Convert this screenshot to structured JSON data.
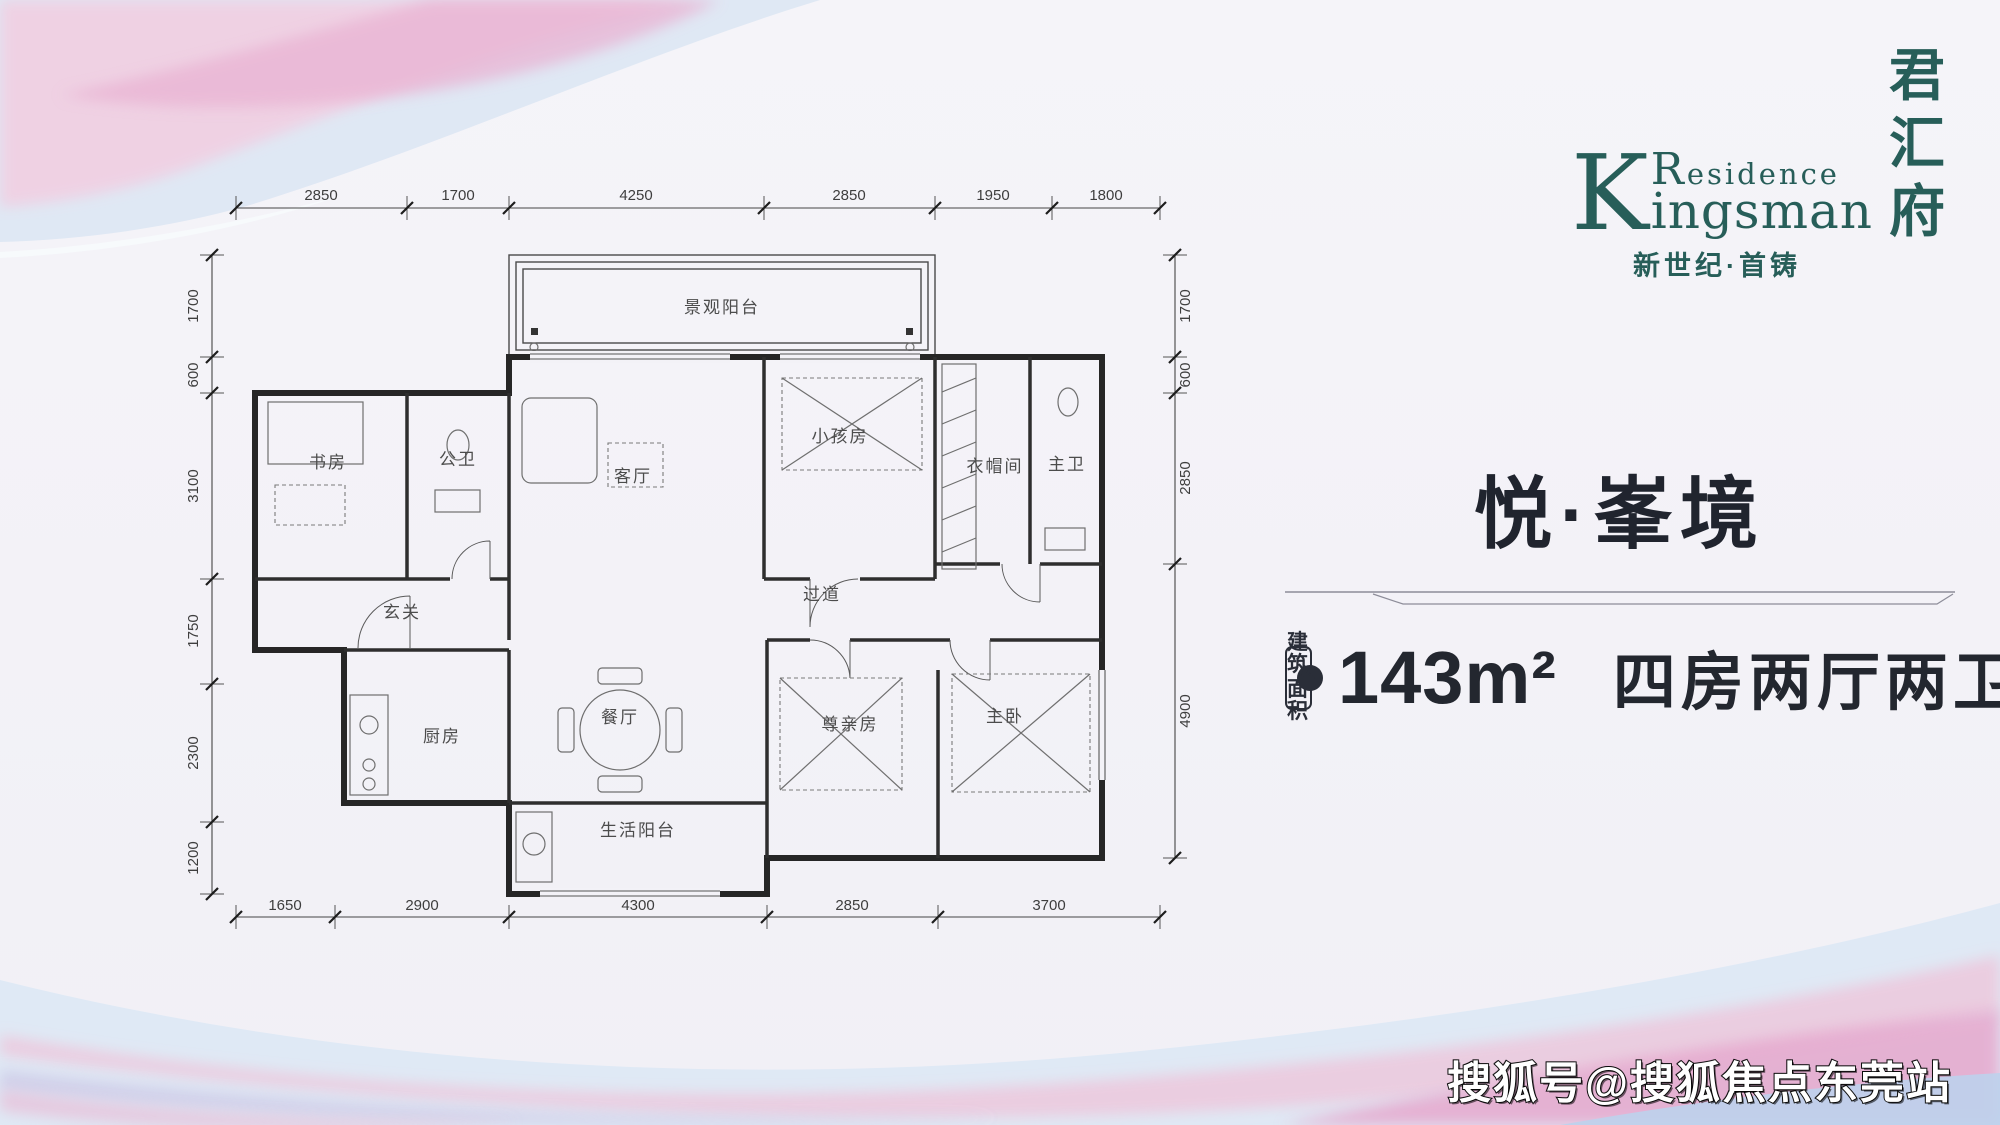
{
  "logo": {
    "k_letter": "K",
    "residence_initial": "R",
    "residence_rest": "esidence",
    "kingsman_rest": "ingsman",
    "cn_chars": [
      "君",
      "汇",
      "府"
    ],
    "tagline": "新世纪·首铸",
    "brand_color": "#275e59"
  },
  "panel": {
    "title": "悦·峯境",
    "area_label_line1": "建筑",
    "area_label_line2": "面积",
    "approx_label": "约",
    "area_value": "143m²",
    "layout_text": "四房两厅两卫",
    "text_color": "#23272f"
  },
  "watermark": {
    "text": "搜狐号@搜狐焦点东莞站"
  },
  "floorplan": {
    "rooms": {
      "view_balcony": "景观阳台",
      "study": "书房",
      "guest_bath": "公卫",
      "living": "客厅",
      "kids_room": "小孩房",
      "cloak_room": "衣帽间",
      "master_bath": "主卫",
      "foyer": "玄关",
      "corridor": "过道",
      "dining": "餐厅",
      "kitchen": "厨房",
      "elder_room": "尊亲房",
      "master_bedroom": "主卧",
      "utility_balcony": "生活阳台"
    },
    "dims": {
      "top": [
        "2850",
        "1700",
        "4250",
        "2850",
        "1950",
        "1800"
      ],
      "bottom": [
        "1650",
        "2900",
        "4300",
        "2850",
        "3700"
      ],
      "left": [
        "1700",
        "600",
        "3100",
        "1750",
        "2300",
        "1200"
      ],
      "right": [
        "1700",
        "600",
        "2850",
        "4900"
      ]
    }
  }
}
